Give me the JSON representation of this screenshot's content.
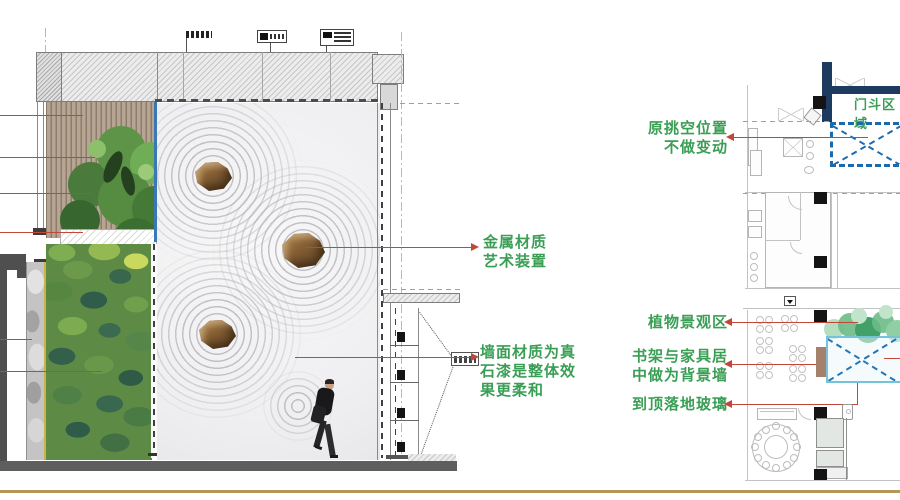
{
  "annotations": {
    "metal_art": {
      "line1": "金属材质",
      "line2": "艺术装置"
    },
    "wall_paint": {
      "line1": "墙面材质为真",
      "line2": "石漆是整体效",
      "line3": "果更柔和"
    },
    "original_void": {
      "line1": "原挑空位置",
      "line2": "不做变动"
    },
    "vestibule_zone": "门斗区域",
    "plant_zone": "植物景观区",
    "bookshelf_wall": {
      "line1": "书架与家具居",
      "line2": "中做为背景墙"
    },
    "ceiling_glass": "到顶落地玻璃"
  },
  "colors": {
    "annotation_green": "#3a9e55",
    "leader_red": "#c2473b",
    "navy_wall": "#1d3b5e",
    "dashed_blue": "#1a6aad",
    "highlight_blue": "#74c3db",
    "gold_divider": "#b5975a",
    "sand": "#f1f1f3",
    "wood_slats": "#b09e8c",
    "moss_green": "#5d8a45"
  }
}
